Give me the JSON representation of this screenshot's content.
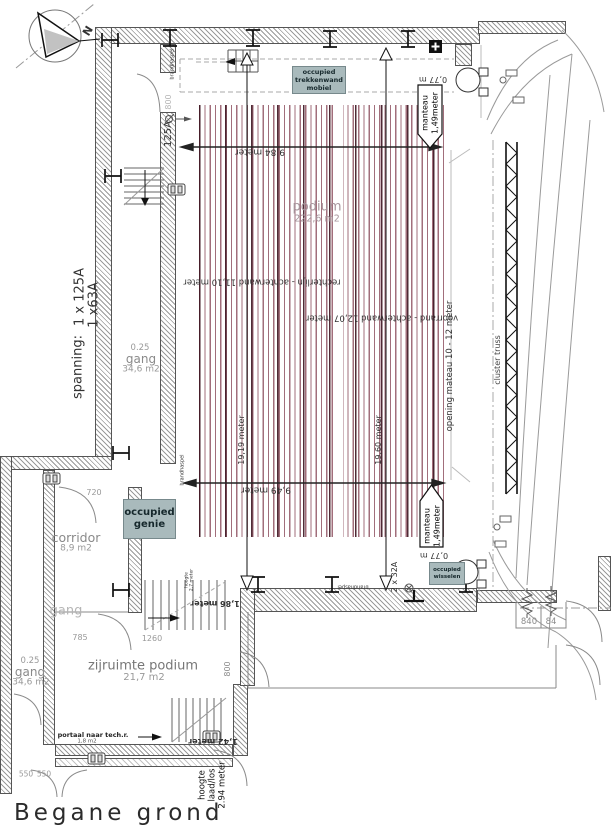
{
  "title": "Begane grond",
  "compass": {
    "north": "N"
  },
  "rooms": {
    "podium": {
      "name": "podium",
      "area": "222,6 m2"
    },
    "gang_mid": {
      "ratio": "0.25",
      "name": "gang",
      "area": "34,6 m2"
    },
    "gang_low": {
      "ratio": "0.25",
      "name": "gang",
      "area": "34,6 m2"
    },
    "gang_small": {
      "name": "gang"
    },
    "corridor": {
      "name": "corridor",
      "area": "8,9 m2"
    },
    "zijruimte": {
      "name": "zijruimte podium",
      "area": "21,7 m2"
    },
    "portaal": {
      "name": "portaal naar tech.r.",
      "area": "1,8 m2"
    }
  },
  "dims": {
    "w_top": "9,84 meter",
    "w_bottom": "9,49 meter",
    "h_left": "19,19 meter",
    "h_right": "19,60 meter",
    "rechterlijn": "rechterlijn - achterwand 11,10 meter",
    "voorrand": "voorrand - achterwand 12,07 meter",
    "opening": "opening mateau 10 - 12 meter",
    "d720": "720",
    "d785": "785",
    "d1260": "1260",
    "d800": "800",
    "d550": "550",
    "m142": "1,42 meter",
    "m186": "1,86 meter",
    "n840": "840",
    "n84": "84",
    "manteau_w": "0,77 m"
  },
  "power": {
    "spanning": "spanning:",
    "amp1": "1 x 125A",
    "amp2": "1 x63A",
    "a125": "125A",
    "a2x32": "2 x 32A"
  },
  "notes": {
    "occ_trekkenwand": {
      "l1": "occupied",
      "l2": "trekkenwand",
      "l3": "mobiel"
    },
    "occ_genie": {
      "l1": "occupied",
      "l2": "genie"
    },
    "occ_wisselen": {
      "l1": "occupied",
      "l2": "wisselen"
    },
    "manteau": {
      "l1": "manteau",
      "l2": "1,49meter"
    },
    "cluster": "cluster truss",
    "brandhaspel": "brandhaspel",
    "hoogte_laad": {
      "l1": "hoogte",
      "l2": "laad/los",
      "l3": "2.94 meter"
    },
    "hoogte27": {
      "l1": "hoogte",
      "l2": "2,7 meter"
    }
  },
  "colors": {
    "stripe": "#8a4a5a",
    "occupied_bg": "#a9babc",
    "wall_hatch": "#9a9a9a"
  }
}
